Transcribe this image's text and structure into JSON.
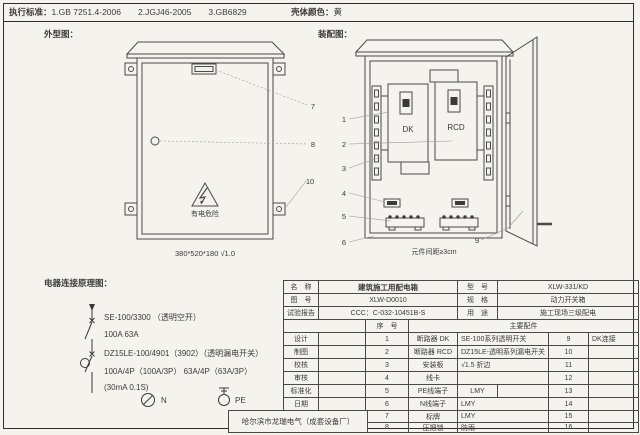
{
  "header": {
    "standards_label": "执行标准：",
    "standards": "1.GB 7251.4-2006　　2.JGJ46-2005　　3.GB6829",
    "shell_color_label": "壳体颜色：",
    "shell_color": "黄"
  },
  "section_labels": {
    "outline": "外型图：",
    "assembly": "装配图：",
    "schematic": "电器连接原理图："
  },
  "outline_drawing": {
    "warning_text": "有电危险",
    "dimension_note": "380*520*180  √1.0"
  },
  "assembly_drawing": {
    "dk_label": "DK",
    "rcd_label": "RCD",
    "spacing_note": "元件间距≥3cm"
  },
  "callouts": [
    "1",
    "2",
    "3",
    "4",
    "5",
    "6",
    "7",
    "8",
    "9",
    "10"
  ],
  "schematic": {
    "lines": [
      "SE-100/3300 （透明空开）",
      "100A  63A",
      "DZ15LE-100/4901（3902）（透明漏电开关）",
      "100A/4P（100A/3P）  63A/4P（63A/3P）",
      "(30mA 0.1S)"
    ],
    "n_label": "N",
    "pe_label": "PE"
  },
  "title_block": {
    "name_label": "名　称",
    "name_value": "建筑施工用配电箱",
    "model_label": "型　号",
    "model_value": "XLW-331/KD",
    "drawing_no_label": "图　号",
    "drawing_no_value": "XLW-D0010",
    "spec_label": "规　格",
    "spec_value": "动力开关箱",
    "test_report_label": "试验报告",
    "test_report_value": "CCC：C-032-10451B-S",
    "use_label": "用　途",
    "use_value": "施工现场三级配电",
    "seq_header": "序　号",
    "parts_header": "主要配件",
    "sign_labels": [
      "设计",
      "制图",
      "校核",
      "审核",
      "标准化",
      "日期"
    ],
    "company": "哈尔滨市龙瑞电气（成套设备厂）"
  },
  "parts_table": {
    "rows": [
      {
        "no": "1",
        "name": "断路器 DK",
        "spec": "SE-100系列透明开关",
        "no2": "9",
        "name2": "DK连接"
      },
      {
        "no": "2",
        "name": "断路器 RCD",
        "spec": "DZ15LE-透明系列漏电开关",
        "no2": "10",
        "name2": ""
      },
      {
        "no": "3",
        "name": "安装板",
        "spec": "√1.5  折边",
        "no2": "11",
        "name2": ""
      },
      {
        "no": "4",
        "name": "线卡",
        "spec": "",
        "no2": "12",
        "name2": ""
      },
      {
        "no": "5",
        "name": "PE线端子",
        "spec": "LMY",
        "no2": "13",
        "name2": ""
      },
      {
        "no": "6",
        "name": "N线端子",
        "spec": "LMY",
        "no2": "14",
        "name2": ""
      },
      {
        "no": "7",
        "name": "标牌",
        "spec": "LMY",
        "no2": "15",
        "name2": ""
      },
      {
        "no": "8",
        "name": "压把锁",
        "spec": "防雨",
        "no2": "16",
        "name2": ""
      }
    ]
  }
}
